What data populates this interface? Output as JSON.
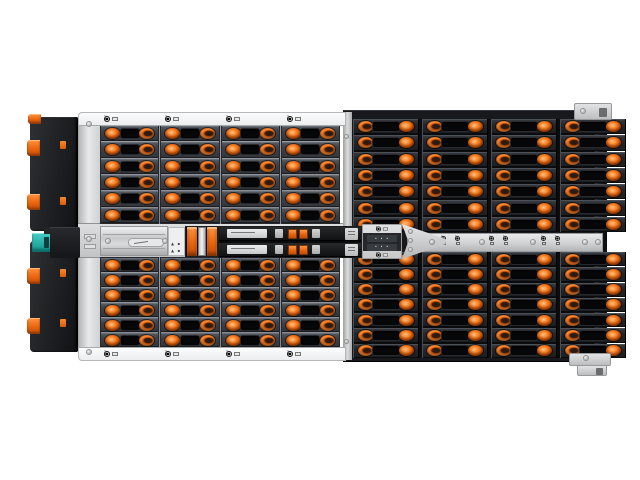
{
  "scene": {
    "description": "Top-down product photo of a 4U rackmount hybrid storage enclosure fully populated with hot-swap drive trays that have orange release latches",
    "background": "#ffffff"
  },
  "palette": {
    "orange": "#ee6a10",
    "orange_highlight": "#ffb36b",
    "orange_shadow": "#8a3a08",
    "tray_left": "#3d4046",
    "tray_right": "#232528",
    "slot_black": "#060708",
    "chassis_silver": "#d9dbdd",
    "strip_white": "#f4f5f7",
    "rail_silver": "#cdcfd1",
    "module_black": "#1b1d20",
    "teal_clip": "#2bb7af",
    "edge_dark": "#141619"
  },
  "left_bay": {
    "columns": 4,
    "rows_top": 6,
    "rows_bottom": 6,
    "strip_icons": 4
  },
  "right_bay": {
    "columns": 4,
    "rows_top": 7,
    "rows_bottom": 7
  },
  "center_assembly": {
    "sled_rows": 2,
    "latch_bars": 2,
    "rail_icon_pairs": 3,
    "rail_screw_count": 5,
    "port_plate_rows": 2,
    "port_plate_micro_label": "• • •",
    "warning_label_glyphs": "▲ ▪"
  },
  "icons": {
    "strip_port_icon": "info-power-drive-icon",
    "rail_port_icon": "info-power-icon",
    "warning_label_icon": "warning-triangle-icon",
    "teal_clip_icon": "cable-clip",
    "port_icon_letter": "i"
  },
  "fan_modules": {
    "count": 2,
    "latch_tabs_per_module": 2
  }
}
